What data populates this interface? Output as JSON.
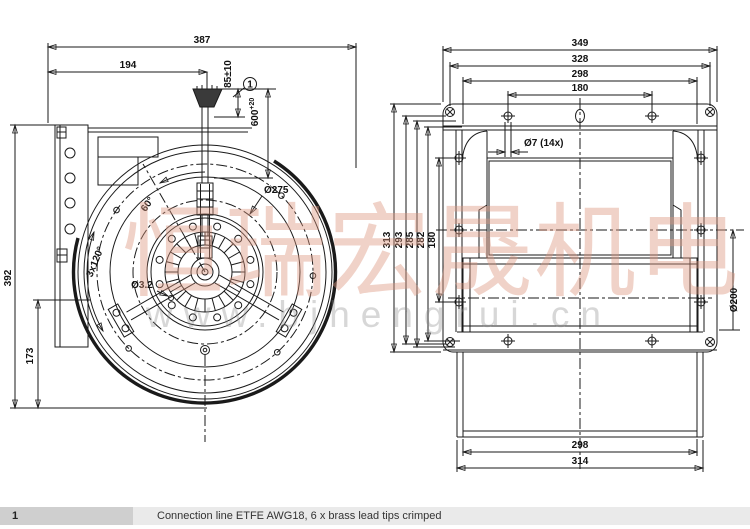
{
  "front": {
    "dim_387": "387",
    "dim_194": "194",
    "dim_85": "85±10",
    "dim_600": "600",
    "dim_600_tol": "+20",
    "callout_1": "1",
    "dia_275": "Ø275",
    "dim_392": "392",
    "dim_173": "173",
    "dia_32": "Ø3.2",
    "angle_3x120": "3x120°",
    "angle_60": "60°"
  },
  "side": {
    "dim_349": "349",
    "dim_328": "328",
    "dim_298_top": "298",
    "dim_180_top": "180",
    "hole_note": "Ø7 (14x)",
    "dim_313": "313",
    "dim_293": "293",
    "dim_285": "285",
    "dim_282": "282",
    "dim_180_left": "180",
    "dia_200": "Ø200",
    "dim_298_bottom": "298",
    "dim_314": "314"
  },
  "watermark": {
    "text_cn": "恒瑞宏晟机电",
    "url": "www.bjhengrui.cn",
    "color_pink": "#db937c"
  },
  "note": {
    "index": "1",
    "text": "Connection line ETFE AWG18, 6 x brass lead tips crimped"
  },
  "colors": {
    "line": "#1a1a1a",
    "note_bar": "#eaeaea",
    "note_index_bg": "#cfcfcf"
  }
}
